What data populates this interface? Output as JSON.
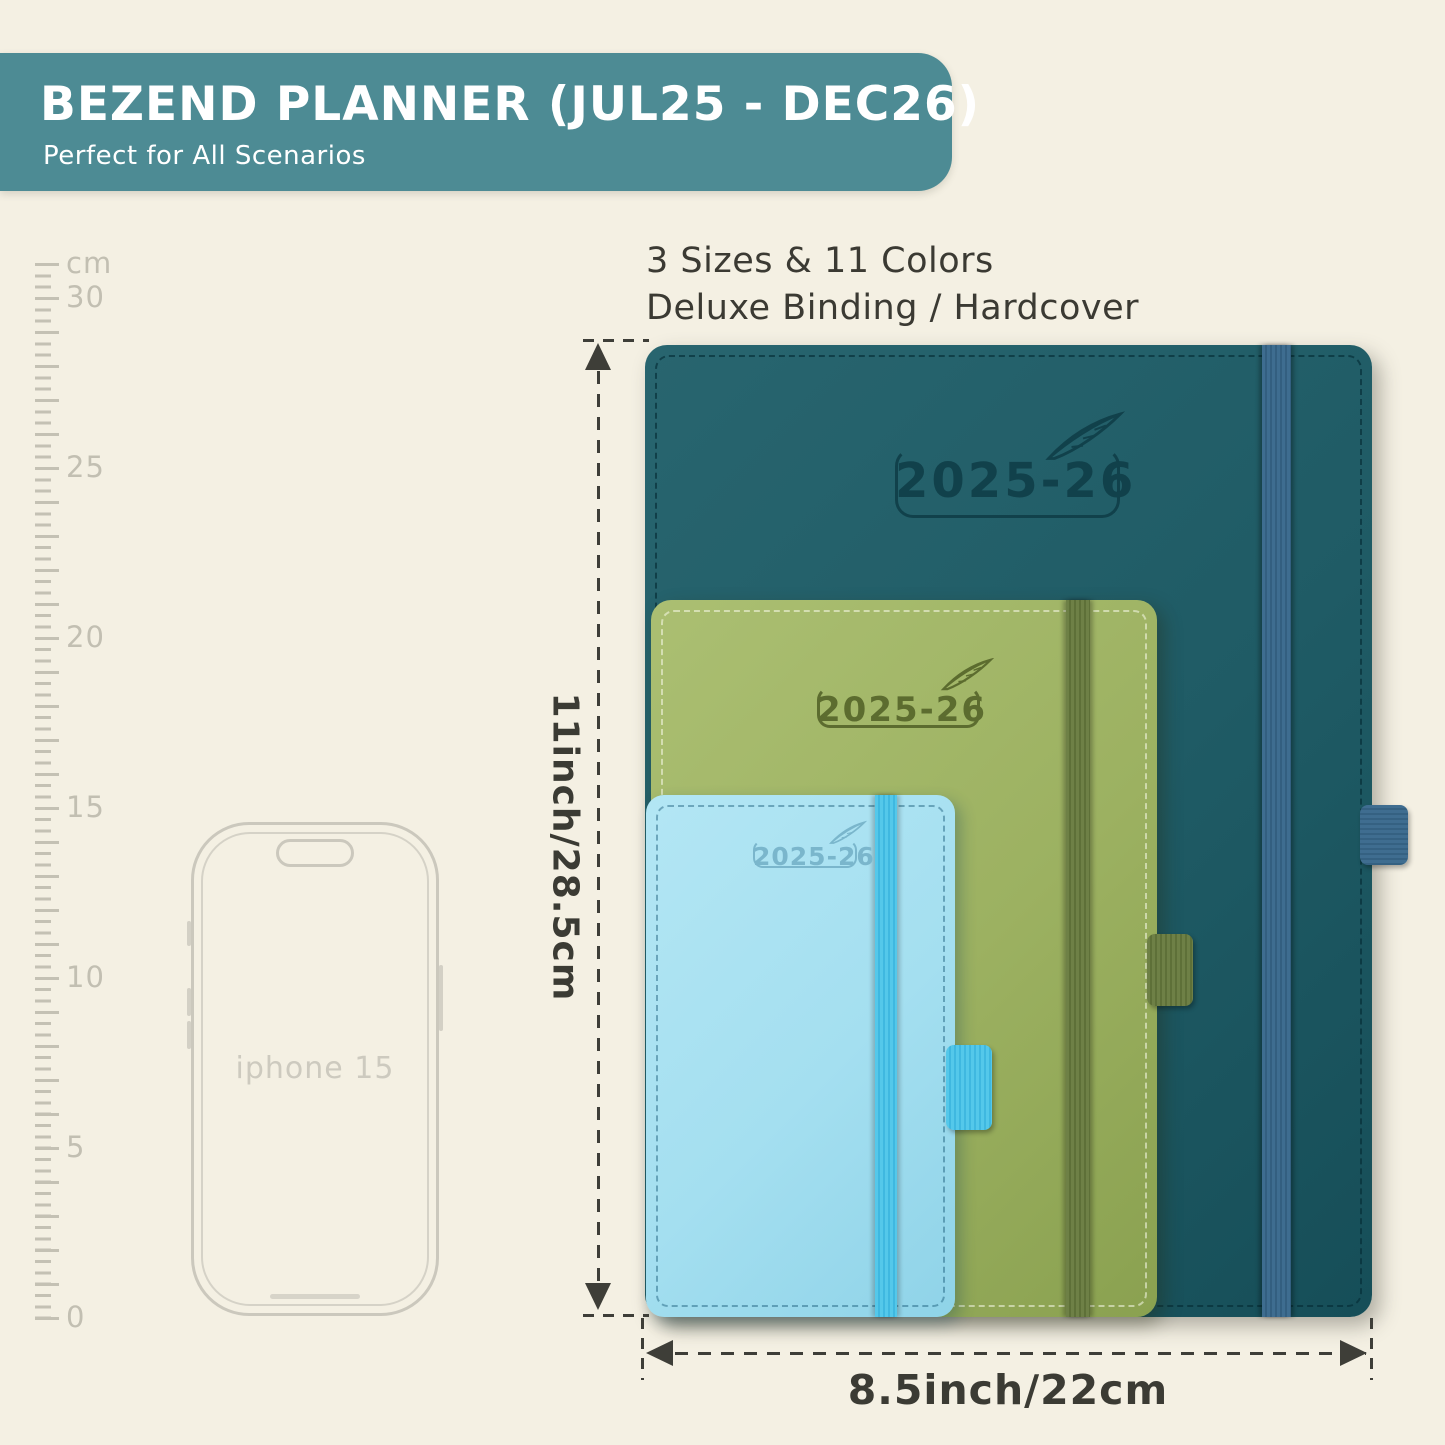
{
  "banner": {
    "title": "BEZEND PLANNER (JUL25 - DEC26)",
    "subtitle": "Perfect for All Scenarios",
    "bg_color": "#4d8b94",
    "text_color": "#ffffff"
  },
  "info": {
    "line1": "3 Sizes & 11 Colors",
    "line2": "Deluxe Binding / Hardcover"
  },
  "ruler": {
    "unit_label": "cm",
    "tick_labels": [
      "30",
      "25",
      "20",
      "15",
      "10",
      "5",
      "0"
    ],
    "tick_color": "#c4c1b4"
  },
  "phone": {
    "label": "iphone 15",
    "outline_color": "#cbc8bd"
  },
  "planners": [
    {
      "size": "large",
      "year_label": "2025-26",
      "cover_color": "#1f5b65",
      "band_color": "#3e6d90",
      "emboss_color": "#11414b"
    },
    {
      "size": "medium",
      "year_label": "2025-26",
      "cover_color": "#9cb161",
      "band_color": "#6e8046",
      "emboss_color": "#5c6c2f"
    },
    {
      "size": "small",
      "year_label": "2025-26",
      "cover_color": "#a4dff0",
      "band_color": "#54c8ea",
      "emboss_color": "#7ab6cc"
    }
  ],
  "dimensions": {
    "height_label": "11inch/28.5cm",
    "width_label": "8.5inch/22cm",
    "line_color": "#3e3e38"
  },
  "background_color": "#f4f0e3"
}
